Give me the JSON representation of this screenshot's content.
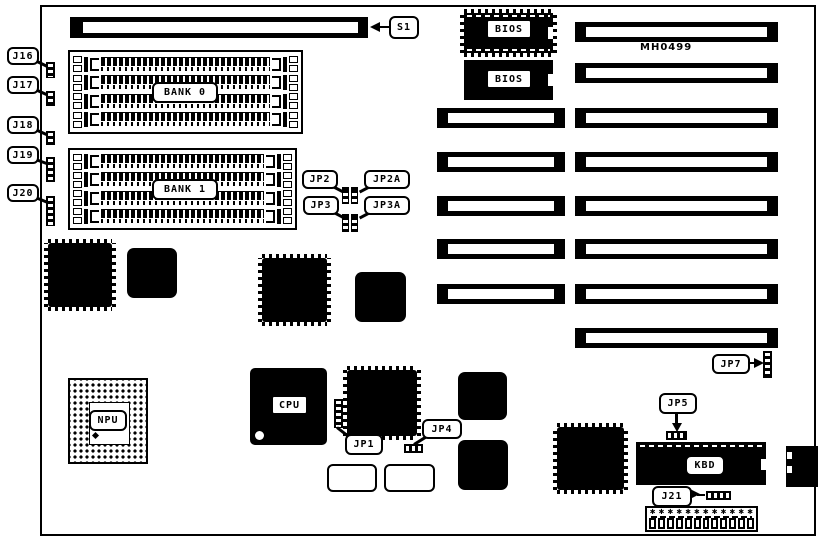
{
  "board": {
    "id_text": "MH0499"
  },
  "labels": {
    "s1": "S1",
    "j16": "J16",
    "j17": "J17",
    "j18": "J18",
    "j19": "J19",
    "j20": "J20",
    "j21": "J21",
    "jp1": "JP1",
    "jp2": "JP2",
    "jp2a": "JP2A",
    "jp3": "JP3",
    "jp3a": "JP3A",
    "jp4": "JP4",
    "jp5": "JP5",
    "jp7": "JP7",
    "bank0": "BANK 0",
    "bank1": "BANK 1",
    "bios_top": "BIOS",
    "bios_bottom": "BIOS",
    "cpu": "CPU",
    "npu": "NPU",
    "kbd": "KBD"
  },
  "colors": {
    "ink": "#000000",
    "paper": "#ffffff"
  }
}
